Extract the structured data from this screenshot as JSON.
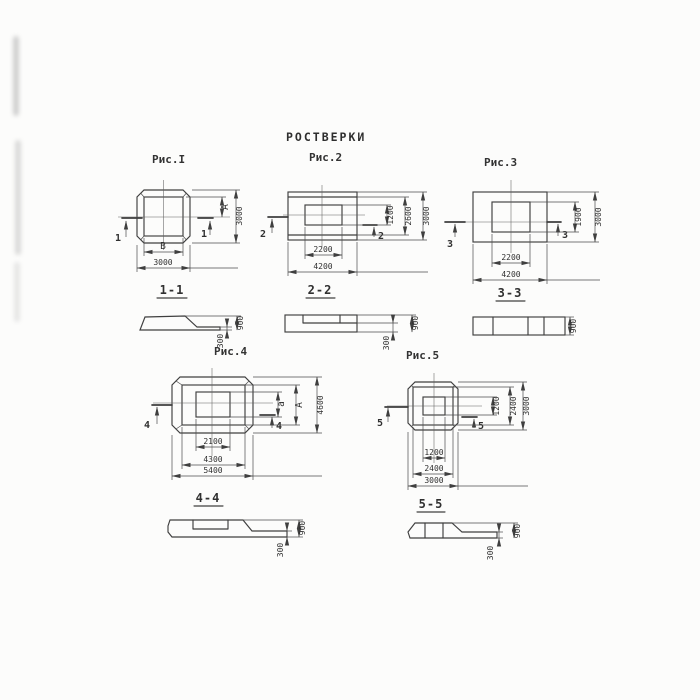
{
  "title": "РОСТВЕРКИ",
  "colors": {
    "ink": "#3f3f3f",
    "paper": "#fcfcfb"
  },
  "figures": [
    {
      "label": "Рис.I",
      "cut_mark": "1",
      "plan": {
        "right_dim_inner": "А",
        "right_dim_outer": "3000",
        "bottom_dim_inner": "В",
        "bottom_dim_outer": "3000"
      },
      "section": {
        "label": "1-1",
        "dim_total_height": "900",
        "dim_edge_height": "300"
      }
    },
    {
      "label": "Рис.2",
      "cut_mark": "2",
      "plan": {
        "right_dim_inner": "1200",
        "right_dim_mid": "2600",
        "right_dim_outer": "3000",
        "bottom_dim_inner": "2200",
        "bottom_dim_outer": "4200"
      },
      "section": {
        "label": "2-2",
        "dim_total_height": "900",
        "dim_edge_height": "300"
      }
    },
    {
      "label": "Рис.3",
      "cut_mark": "3",
      "plan": {
        "right_dim_inner": "1900",
        "right_dim_outer": "3000",
        "bottom_dim_inner": "2200",
        "bottom_dim_outer": "4200"
      },
      "section": {
        "label": "3-3",
        "dim_total_height": "900"
      }
    },
    {
      "label": "Рис.4",
      "cut_mark": "4",
      "plan": {
        "right_dim_inner": "а",
        "right_dim_mid": "А",
        "right_dim_outer": "4600",
        "bottom_dim_inner": "2100",
        "bottom_dim_mid": "4300",
        "bottom_dim_outer": "5400"
      },
      "section": {
        "label": "4-4",
        "dim_total_height": "900",
        "dim_edge_height": "300"
      }
    },
    {
      "label": "Рис.5",
      "cut_mark": "5",
      "plan": {
        "right_dim_inner": "1200",
        "right_dim_mid": "2400",
        "right_dim_outer": "3000",
        "bottom_dim_inner": "1200",
        "bottom_dim_mid": "2400",
        "bottom_dim_outer": "3000"
      },
      "section": {
        "label": "5-5",
        "dim_total_height": "900",
        "dim_edge_height": "300"
      }
    }
  ]
}
